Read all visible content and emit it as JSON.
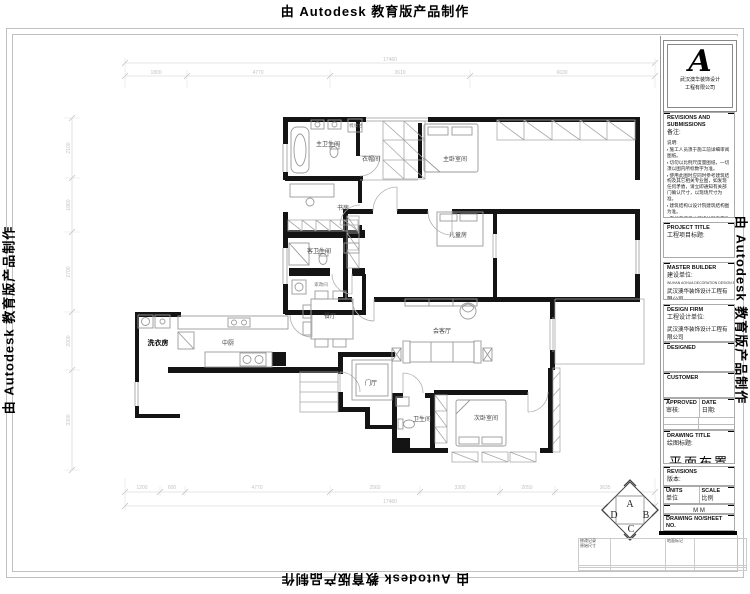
{
  "watermark": {
    "text": "由 Autodesk 教育版产品制作"
  },
  "title_block": {
    "logo": {
      "letter": "A",
      "company_line1": "武汉澳华装饰设计",
      "company_line2": "工程有限公司"
    },
    "revisions_header": "REVISIONS AND SUBMISSIONS",
    "revisions_header_cn": "备注:",
    "notes_title": "说明:",
    "notes": [
      "施工人员须于施工前详细审阅图纸。",
      "切勿以比例尺度量图纸，一切须以图内所标数字为准。",
      "使用此图时应同时参考建筑结构及其它相关专业图，如发现任何矛盾，请立即通知有关部门确认尺寸，以现场尺寸为准。",
      "建筑结构以设计院建筑结构图为准。",
      "未加盖澳华公司设计图章不准在施工中使用。"
    ],
    "project_title": "PROJECT TITLE",
    "project_title_cn": "工程项目标题:",
    "master_builder": "MASTER BUILDER",
    "master_builder_cn": "建设单位:",
    "master_builder_en": "WUHAN AOHUA DECORATION DESIGN ENGINEERING CO.,LTD",
    "master_builder_company": "武汉澳华装饰设计工程有限公司",
    "design_firm": "DESIGN FIRM",
    "design_firm_cn": "工程设计单位:",
    "design_firm_company": "武汉澳华装饰设计工程有限公司",
    "designed": "DESIGNED",
    "customer": "CUSTOMER",
    "approved": "APPROVED",
    "approved_cn": "审核:",
    "date": "DATE",
    "date_cn": "日期:",
    "drawing_title": "DRAWING TITLE",
    "drawing_title_cn": "绘图标题:",
    "drawing_name": "平面布置图",
    "revisions2": "REVISIONS",
    "revisions2_cn": "版本:",
    "units": "UNITS",
    "units_cn": "单位",
    "units_value": "M M",
    "scale": "SCALE",
    "scale_cn": "比例",
    "drawing_no": "DRAWING NO/SHEET NO.",
    "drawing_no_cn": "图别:",
    "sheet_no_cn": "图号:"
  },
  "floor_plan": {
    "rooms": [
      {
        "label": "主卫生间",
        "x": 328,
        "y": 146,
        "cls": ""
      },
      {
        "label": "梳妆台",
        "x": 356,
        "y": 127,
        "cls": "small"
      },
      {
        "label": "衣帽间",
        "x": 371,
        "y": 161,
        "cls": ""
      },
      {
        "label": "主卧室间",
        "x": 455,
        "y": 161,
        "cls": ""
      },
      {
        "label": "书房",
        "x": 343,
        "y": 210,
        "cls": ""
      },
      {
        "label": "客卫生间",
        "x": 319,
        "y": 253,
        "cls": ""
      },
      {
        "label": "家政间",
        "x": 321,
        "y": 286,
        "cls": "small"
      },
      {
        "label": "儿童房",
        "x": 458,
        "y": 237,
        "cls": ""
      },
      {
        "label": "餐厅",
        "x": 330,
        "y": 318,
        "cls": ""
      },
      {
        "label": "中厨",
        "x": 228,
        "y": 345,
        "cls": ""
      },
      {
        "label": "洗衣房",
        "x": 158,
        "y": 345,
        "cls": "bold"
      },
      {
        "label": "会客厅",
        "x": 442,
        "y": 333,
        "cls": ""
      },
      {
        "label": "门厅",
        "x": 371,
        "y": 385,
        "cls": ""
      },
      {
        "label": "卫生间",
        "x": 422,
        "y": 421,
        "cls": ""
      },
      {
        "label": "次卧室间",
        "x": 486,
        "y": 420,
        "cls": ""
      }
    ],
    "compass": {
      "letters": [
        "A",
        "B",
        "C",
        "D"
      ]
    },
    "dimensions": {
      "top_total": {
        "text": "17460",
        "x": 390,
        "y": 61
      },
      "top_segments": [
        {
          "text": "1800",
          "x": 156,
          "y": 74
        },
        {
          "text": "4770",
          "x": 258,
          "y": 74
        },
        {
          "text": "3610",
          "x": 400,
          "y": 74
        },
        {
          "text": "6630",
          "x": 562,
          "y": 74
        }
      ],
      "bottom_segments": [
        {
          "text": "1200",
          "x": 142,
          "y": 489
        },
        {
          "text": "600",
          "x": 172,
          "y": 489
        },
        {
          "text": "4770",
          "x": 257,
          "y": 489
        },
        {
          "text": "2560",
          "x": 375,
          "y": 489
        },
        {
          "text": "3300",
          "x": 460,
          "y": 489
        },
        {
          "text": "2050",
          "x": 527,
          "y": 489
        },
        {
          "text": "3635",
          "x": 605,
          "y": 489
        }
      ],
      "bottom_total": {
        "text": "17460",
        "x": 390,
        "y": 503
      },
      "left_segments": [
        {
          "text": "2100",
          "x": 70,
          "y": 148,
          "rot": true
        },
        {
          "text": "1860",
          "x": 70,
          "y": 205,
          "rot": true
        },
        {
          "text": "2700",
          "x": 70,
          "y": 272,
          "rot": true
        },
        {
          "text": "2000",
          "x": 70,
          "y": 341,
          "rot": true
        },
        {
          "text": "3300",
          "x": 70,
          "y": 420,
          "rot": true
        }
      ]
    }
  },
  "footer_table": {
    "r1c1_line1": "修改记录",
    "r1c1_line2": "原始尺寸",
    "r1c3": "地面标记"
  }
}
